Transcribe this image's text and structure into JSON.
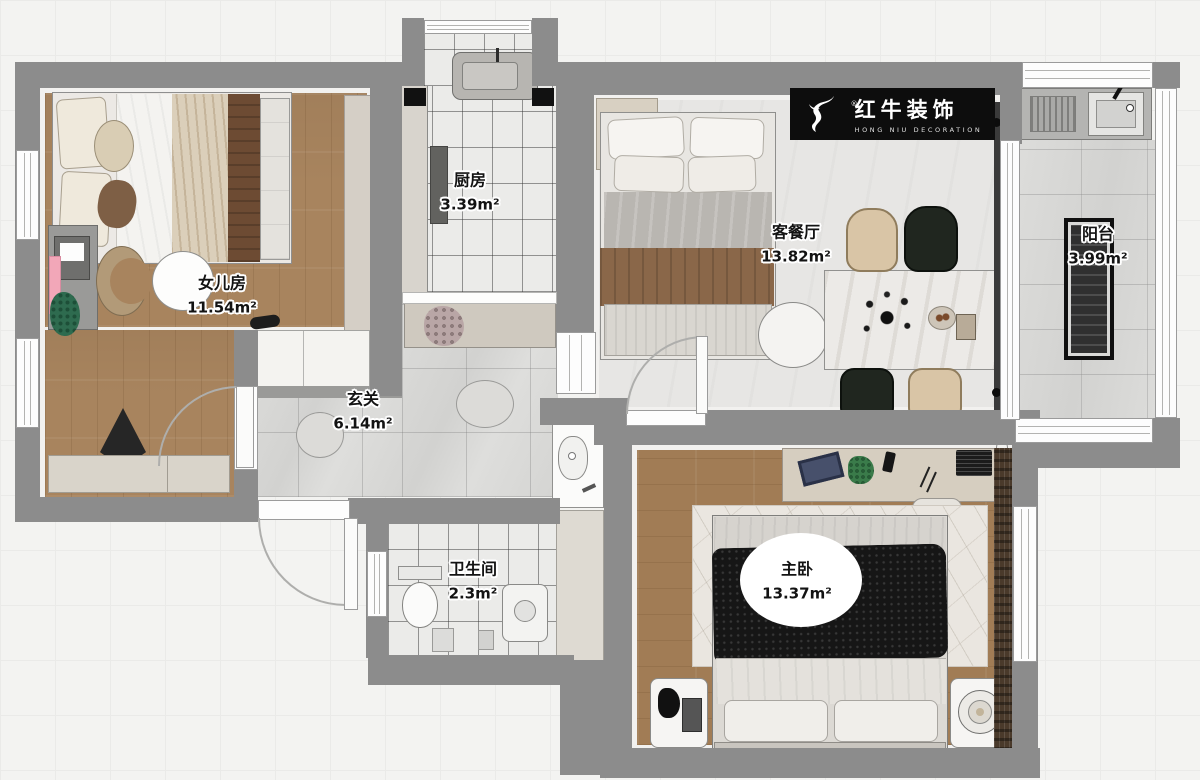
{
  "title": "apartment-floor-plan",
  "brand": {
    "registered": "®",
    "name_cn": "红牛装饰",
    "name_en": "HONG NIU DECORATION"
  },
  "rooms": [
    {
      "key": "daughter_room",
      "name": "女儿房",
      "area": "11.54m²"
    },
    {
      "key": "kitchen",
      "name": "厨房",
      "area": "3.39m²"
    },
    {
      "key": "living_dining",
      "name": "客餐厅",
      "area": "13.82m²"
    },
    {
      "key": "balcony",
      "name": "阳台",
      "area": "3.99m²"
    },
    {
      "key": "hall",
      "name": "玄关",
      "area": "6.14m²"
    },
    {
      "key": "bathroom",
      "name": "卫生间",
      "area": "2.3m²"
    },
    {
      "key": "master_bedroom",
      "name": "主卧",
      "area": "13.37m²"
    }
  ],
  "colors": {
    "wall": "#8c8c8c",
    "wood_floor": "#a8845e",
    "hall_tile": "#d7d7d5",
    "logo_background": "#0d0d0d",
    "blanket_black": "#161616",
    "chair_beige": "#d9c5a6",
    "chair_dark": "#20261f",
    "desk_pink": "#f2a7b8"
  }
}
